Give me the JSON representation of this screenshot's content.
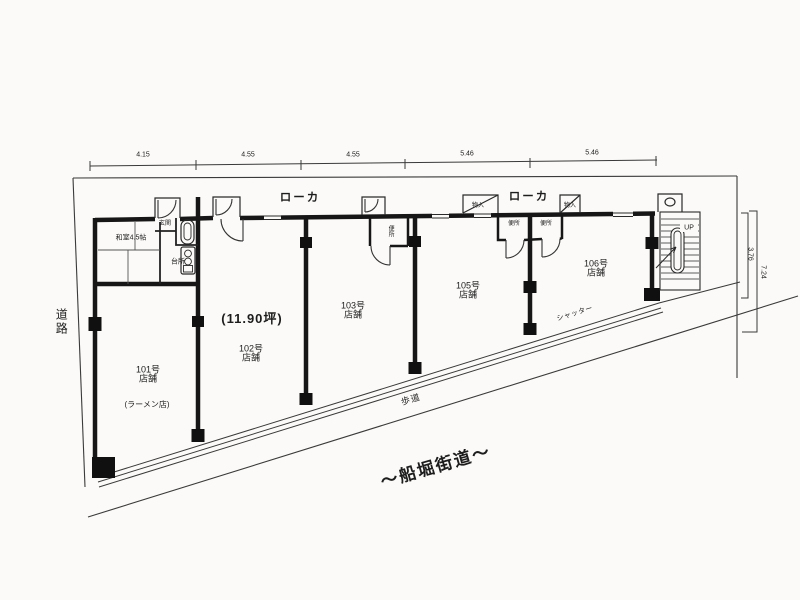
{
  "plan": {
    "top_dimensions": [
      "4.15",
      "4.55",
      "4.55",
      "5.46",
      "5.46"
    ],
    "right_dimensions": [
      "3.76",
      "7.24"
    ],
    "corridor_labels": [
      "ローカ",
      "ローカ"
    ],
    "units": [
      {
        "number": "101号",
        "type": "店舗",
        "note": "(ラーメン店)"
      },
      {
        "number": "102号",
        "type": "店舗",
        "area": "(11.90坪)"
      },
      {
        "number": "103号",
        "type": "店舗"
      },
      {
        "number": "105号",
        "type": "店舗"
      },
      {
        "number": "106号",
        "type": "店舗"
      }
    ],
    "rooms": {
      "washitsu": "和室4.5帖",
      "kitchen": "台所",
      "entrance": "玄関",
      "toilet_103": "便所",
      "toilet_105": "便所",
      "toilet_106": "便所",
      "storage_105": "物入",
      "storage_106": "物入"
    },
    "labels": {
      "shutter": "シャッター",
      "sidewalk": "歩道",
      "road_name": "〜船堀街道〜",
      "side_road": "道路",
      "stairs_up": "UP"
    }
  }
}
